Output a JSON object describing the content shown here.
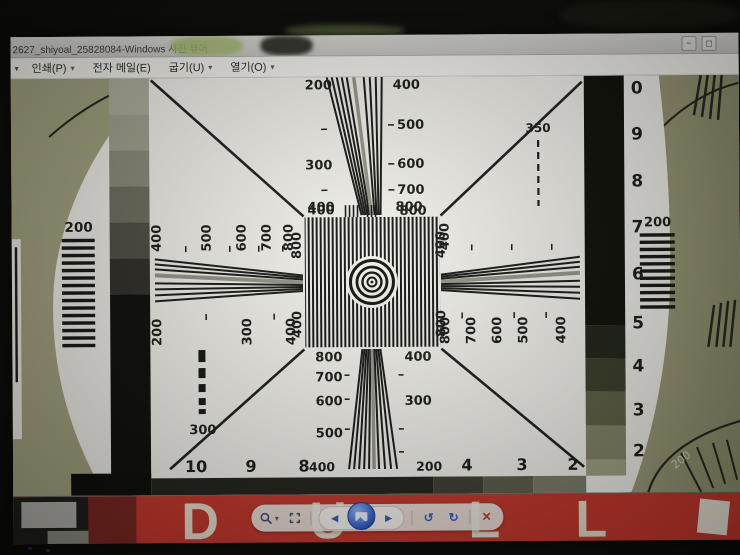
{
  "window": {
    "title": "2627_shiyoal_25828084-Windows 사진 뷰어",
    "controls": {
      "icon1": "−",
      "icon2": "◻"
    }
  },
  "menu": {
    "partial": "▾",
    "items": [
      {
        "label": "인쇄(P)",
        "arrow": "▾"
      },
      {
        "label": "전자 메일(E)",
        "arrow": ""
      },
      {
        "label": "굽기(U)",
        "arrow": "▾"
      },
      {
        "label": "열기(O)",
        "arrow": "▾"
      }
    ]
  },
  "chart": {
    "top_wedge": {
      "left": [
        "200",
        "300",
        "400"
      ],
      "right": [
        "400",
        "500",
        "600",
        "700",
        "800"
      ]
    },
    "dash_350": "350",
    "left_wedge": {
      "top": [
        "400",
        "500",
        "600",
        "700",
        "800"
      ],
      "bottom": [
        "200",
        "300",
        "400"
      ]
    },
    "right_wedge": {
      "top": [
        "400"
      ],
      "bottom": [
        "800",
        "700",
        "600",
        "500",
        "400"
      ]
    },
    "bottom_wedge": {
      "left": [
        "800",
        "700",
        "600",
        "500"
      ],
      "right": [
        "400",
        "300"
      ]
    },
    "square": {
      "top_left": "400",
      "top_right": "800",
      "left_top": "800",
      "left_bottom": "400",
      "right_top": "400",
      "right_bottom": "800"
    },
    "grating_left": "200",
    "grating_right": "200",
    "dash_300": "300",
    "right_scale": [
      "0",
      "9",
      "8",
      "7",
      "6",
      "5",
      "4",
      "3",
      "2"
    ],
    "bottom_scale": [
      "10",
      "9",
      "8",
      "400",
      "200",
      "4",
      "3",
      "2"
    ],
    "corner_200": "200"
  },
  "toolbar": {
    "zoom_arrow": "▾",
    "previous": "◄",
    "next": "►",
    "rotate_ccw": "↺",
    "rotate_cw": "↻",
    "delete": "×"
  },
  "wallpaper": {
    "letters": [
      "D",
      "U",
      "L",
      "L"
    ]
  },
  "colors": {
    "olive_background": "#a2a17d",
    "chart_white": "#f0efe9",
    "wallpaper_red": "#c5372b",
    "toolbar_blue": "#2e5fc8"
  }
}
